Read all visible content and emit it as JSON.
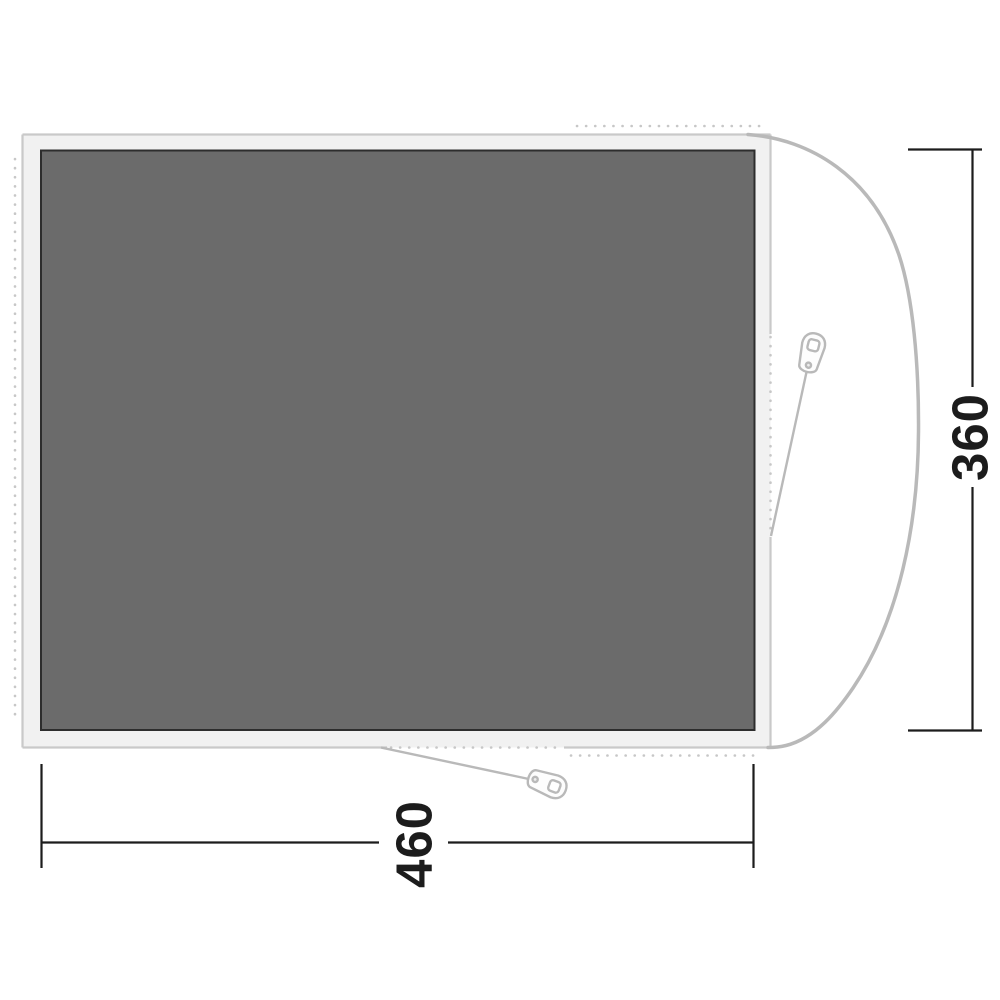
{
  "diagram": {
    "width_dimension": {
      "label": "460"
    },
    "height_dimension": {
      "label": "360"
    }
  },
  "colors": {
    "background": "#ffffff",
    "groundsheet_fill": "#6b6b6b",
    "groundsheet_border": "#2d2d2d",
    "footprint_fill": "#f1f1f1",
    "footprint_outline": "#c9c9c9",
    "tent_outline": "#b9b9b9",
    "attachment_dots": "#c7c7c7",
    "dimension_lines": "#1c1c1c"
  }
}
